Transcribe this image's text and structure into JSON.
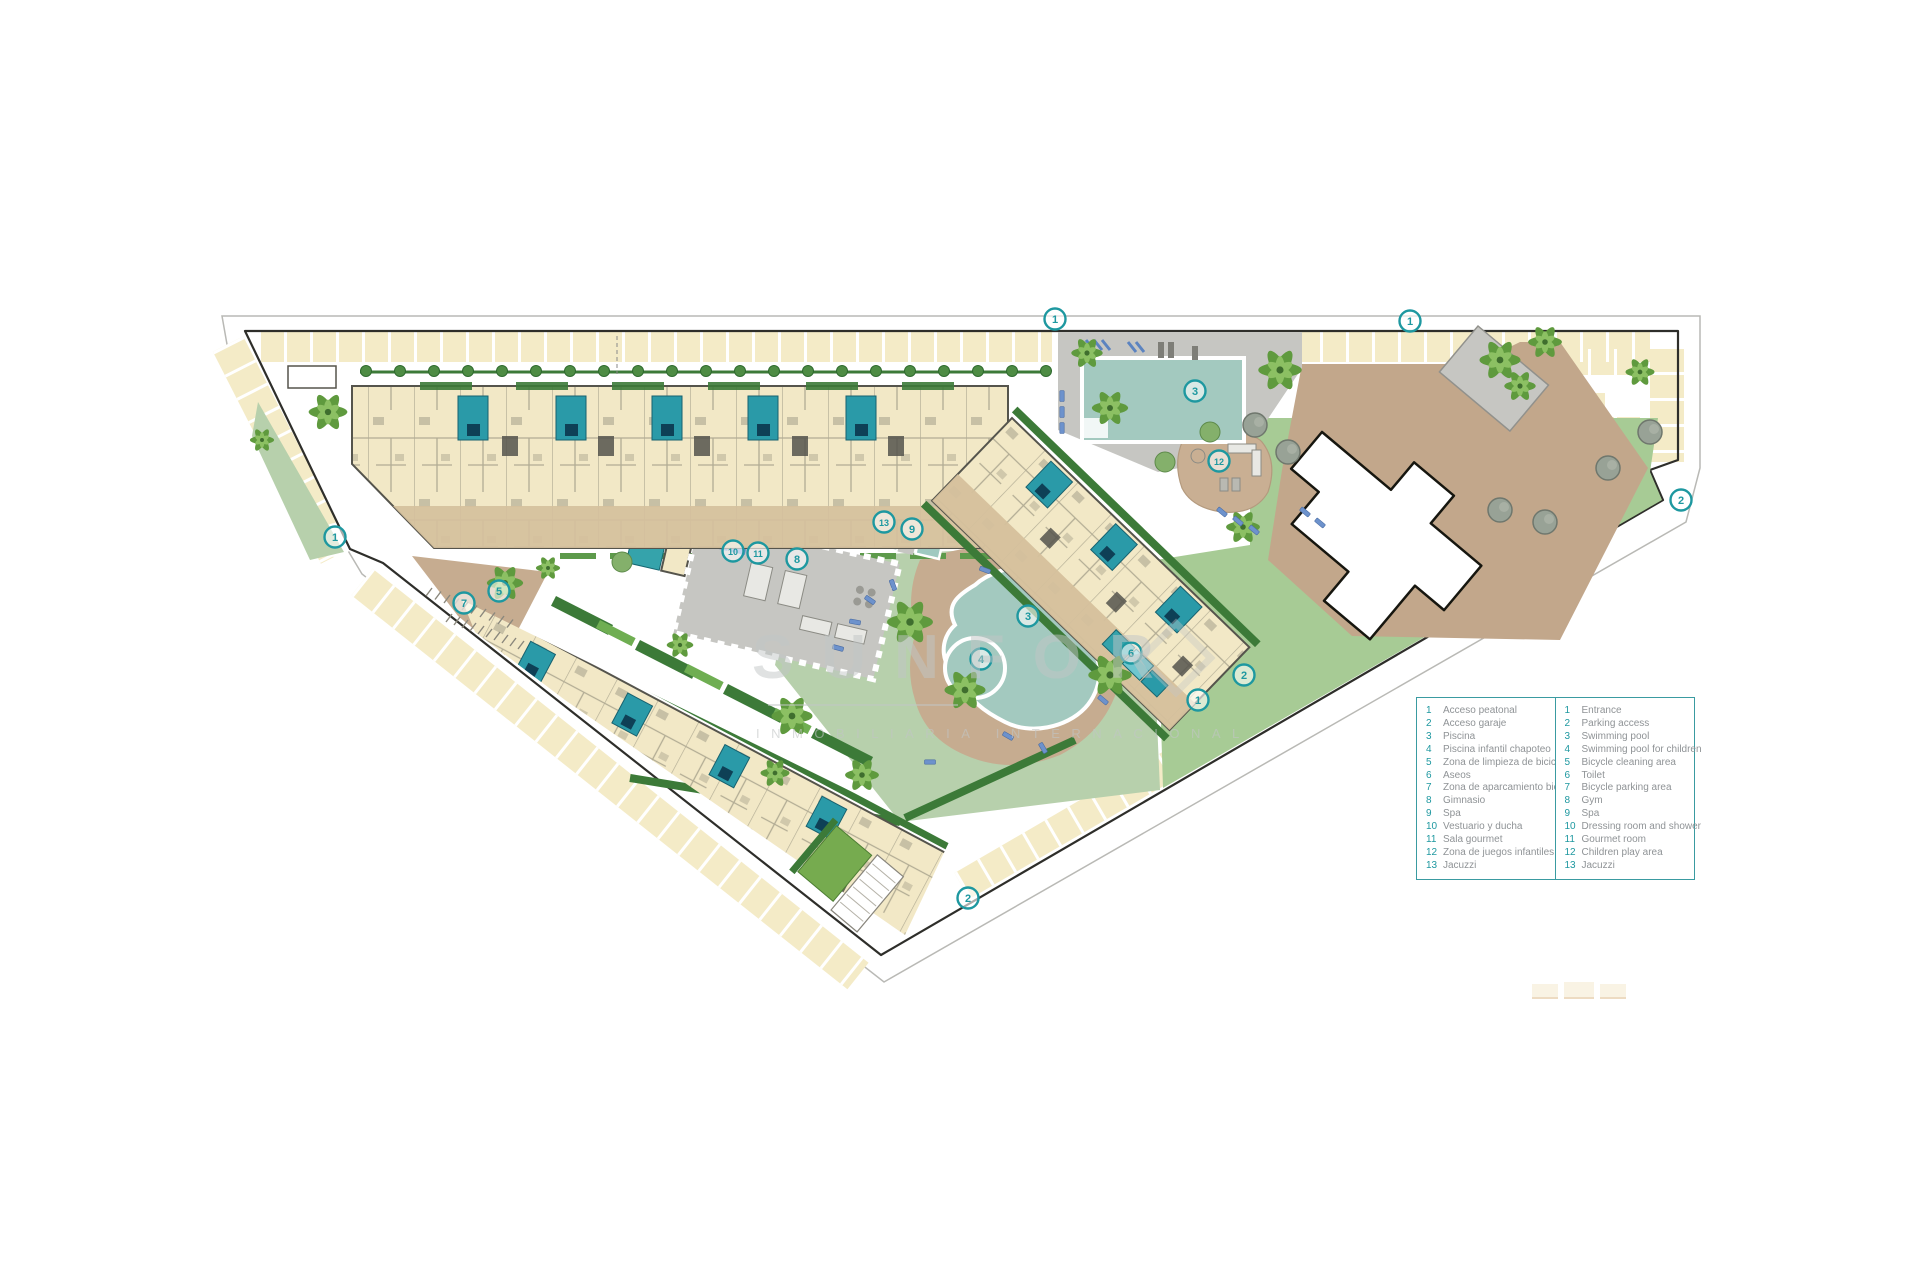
{
  "page": {
    "background": "#ffffff",
    "description": "Residential complex master site plan with numbered amenities legend (Spanish / English)"
  },
  "colors": {
    "accent": "#1e98a0",
    "legend_border": "#3a9ba1",
    "legend_text": "#8f9396",
    "watermark": "#c2c6c6",
    "water": "#a3c9bf",
    "water_light": "#b0d4ca",
    "pool_teal": "#2a9aa8",
    "pool_inner": "#0e4056",
    "lawn_light": "#b7d0ac",
    "lawn_mid": "#a7cb95",
    "lawn_bright": "#76ab4f",
    "hedge": "#3c7a38",
    "hedge_light": "#6fae52",
    "building": "#f2e8c6",
    "wall": "#55544c",
    "terrace": "#d5c09c",
    "terrace_dark": "#c6ac90",
    "deck_gray": "#c6c6c2",
    "plaza": "#c2a78b",
    "stall": "#f4ebc7",
    "road_line": "#b9b9b5",
    "boundary": "#2e2e2a",
    "palm_dark": "#5f9a3e",
    "palm_light": "#8cc063",
    "gray_tree": "#98a296",
    "lounger": "#6d92cc"
  },
  "watermark": {
    "title": "SUNFOR",
    "subtitle": "INMOBILIARIA INTERNACIONAL"
  },
  "legend": {
    "columns": [
      {
        "lang": "es",
        "items": [
          {
            "n": "1",
            "label": "Acceso peatonal"
          },
          {
            "n": "2",
            "label": "Acceso garaje"
          },
          {
            "n": "3",
            "label": "Piscina"
          },
          {
            "n": "4",
            "label": "Piscina infantil chapoteo"
          },
          {
            "n": "5",
            "label": "Zona de limpieza de bicicletas"
          },
          {
            "n": "6",
            "label": "Aseos"
          },
          {
            "n": "7",
            "label": "Zona de aparcamiento bicicletas"
          },
          {
            "n": "8",
            "label": "Gimnasio"
          },
          {
            "n": "9",
            "label": "Spa"
          },
          {
            "n": "10",
            "label": "Vestuario y ducha"
          },
          {
            "n": "11",
            "label": "Sala gourmet"
          },
          {
            "n": "12",
            "label": "Zona de juegos infantiles"
          },
          {
            "n": "13",
            "label": "Jacuzzi"
          }
        ]
      },
      {
        "lang": "en",
        "items": [
          {
            "n": "1",
            "label": "Entrance"
          },
          {
            "n": "2",
            "label": "Parking access"
          },
          {
            "n": "3",
            "label": "Swimming pool"
          },
          {
            "n": "4",
            "label": "Swimming pool for children"
          },
          {
            "n": "5",
            "label": "Bicycle cleaning area"
          },
          {
            "n": "6",
            "label": "Toilet"
          },
          {
            "n": "7",
            "label": "Bicycle parking area"
          },
          {
            "n": "8",
            "label": "Gym"
          },
          {
            "n": "9",
            "label": "Spa"
          },
          {
            "n": "10",
            "label": "Dressing room and shower"
          },
          {
            "n": "11",
            "label": "Gourmet room"
          },
          {
            "n": "12",
            "label": "Children play area"
          },
          {
            "n": "13",
            "label": "Jacuzzi"
          }
        ]
      }
    ]
  },
  "markers": [
    {
      "n": "1",
      "x": 335,
      "y": 537
    },
    {
      "n": "1",
      "x": 1055,
      "y": 319
    },
    {
      "n": "1",
      "x": 1410,
      "y": 321
    },
    {
      "n": "1",
      "x": 1198,
      "y": 700
    },
    {
      "n": "2",
      "x": 968,
      "y": 898
    },
    {
      "n": "2",
      "x": 1244,
      "y": 675
    },
    {
      "n": "2",
      "x": 1681,
      "y": 500
    },
    {
      "n": "3",
      "x": 1195,
      "y": 391
    },
    {
      "n": "3",
      "x": 1028,
      "y": 616
    },
    {
      "n": "4",
      "x": 981,
      "y": 659
    },
    {
      "n": "5",
      "x": 499,
      "y": 591
    },
    {
      "n": "6",
      "x": 1131,
      "y": 653
    },
    {
      "n": "7",
      "x": 464,
      "y": 603
    },
    {
      "n": "8",
      "x": 797,
      "y": 559
    },
    {
      "n": "9",
      "x": 912,
      "y": 529
    },
    {
      "n": "10",
      "x": 733,
      "y": 551
    },
    {
      "n": "11",
      "x": 758,
      "y": 553
    },
    {
      "n": "12",
      "x": 1219,
      "y": 461
    },
    {
      "n": "13",
      "x": 884,
      "y": 522
    }
  ]
}
